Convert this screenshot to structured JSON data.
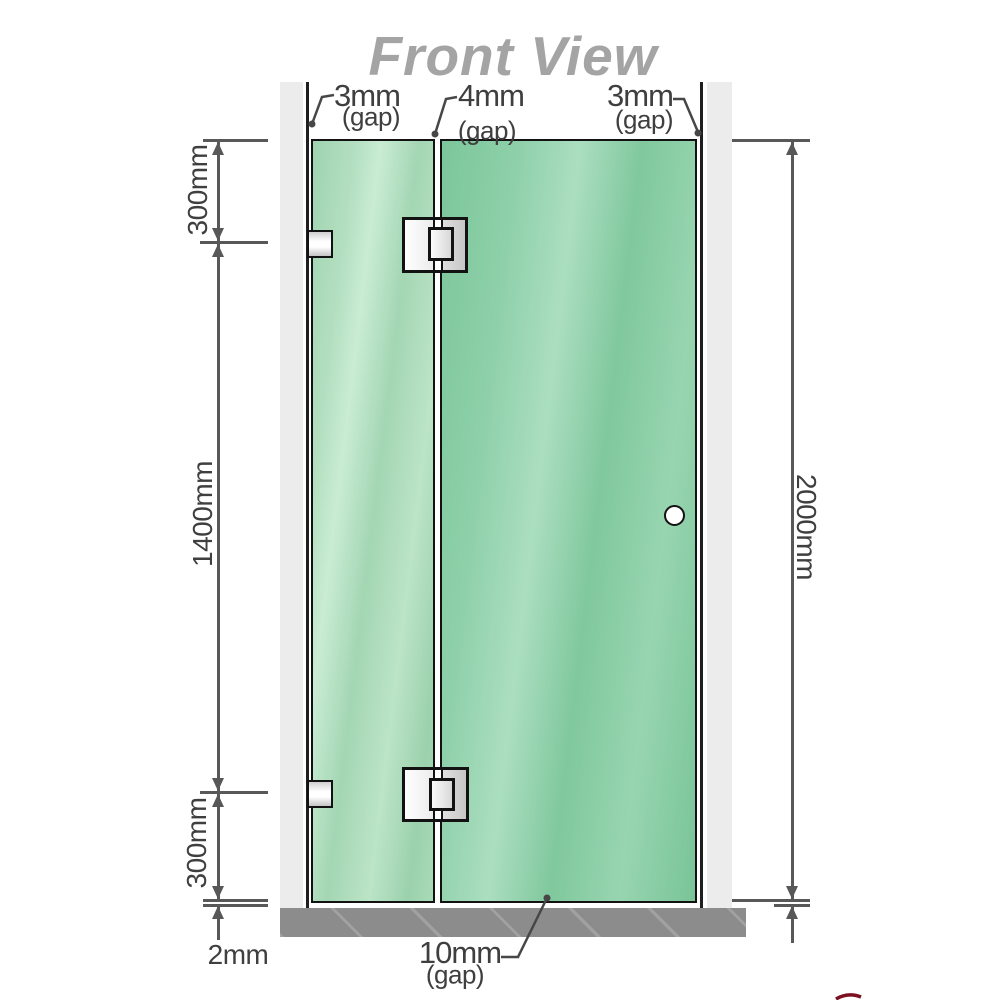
{
  "title": "Front View",
  "annotations": {
    "gap_top_left": {
      "value": "3mm",
      "suffix": "(gap)"
    },
    "gap_top_middle": {
      "value": "4mm",
      "suffix": "(gap)"
    },
    "gap_top_right": {
      "value": "3mm",
      "suffix": "(gap)"
    },
    "gap_bottom": {
      "value": "10mm",
      "suffix": "(gap)"
    },
    "seg_top": "300mm",
    "seg_middle": "1400mm",
    "seg_bottom": "300mm",
    "floor_gap": "2mm",
    "total_height": "2000mm"
  },
  "colors": {
    "glass_fixed_panel": "#a6d9b6",
    "glass_door_panel": "#82c89e",
    "wall_channel": "#ececec",
    "floor": "#8c8c8c",
    "dimension_lines": "#585858",
    "label_text": "#3f3f3f",
    "title_gray": "#a4a4a4",
    "logo_fragment_red": "#7d1020"
  }
}
